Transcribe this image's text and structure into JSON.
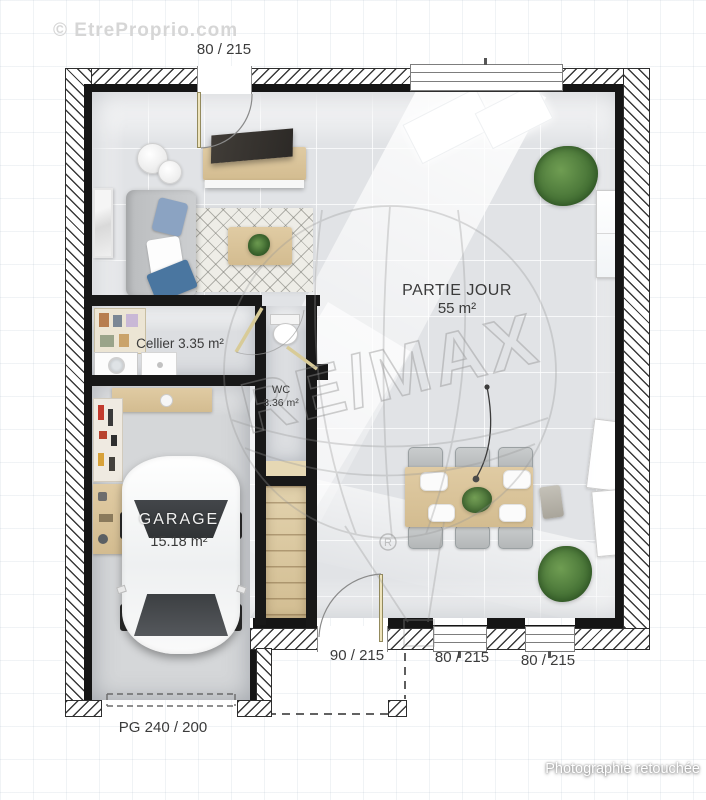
{
  "watermarks": {
    "site": "© EtreProprio.com",
    "brand": "RE/MAX",
    "registered": "R",
    "photo_note": "Photographie retouchée"
  },
  "dimensions": {
    "top_door": "80 / 215",
    "bottom_door": "90 / 215",
    "bottom_window_1": "80 / 215",
    "bottom_window_2": "80 / 215",
    "garage_door": "PG 240 / 200"
  },
  "rooms": {
    "partie_jour": {
      "name": "PARTIE JOUR",
      "area": "55 m²"
    },
    "cellier": {
      "label": "Cellier 3.35 m²"
    },
    "wc": {
      "name": "WC",
      "area": "3.36 m²"
    },
    "garage": {
      "name": "GARAGE",
      "area": "15.18 m²"
    }
  },
  "colors": {
    "wall_edge": "#151515",
    "wood": "#d9c29c",
    "floor_main": "#e1e3e6",
    "floor_garage": "#d4d6d8",
    "plant_green": "#4e7d3c",
    "pillow_blue": "#4a76a0"
  }
}
